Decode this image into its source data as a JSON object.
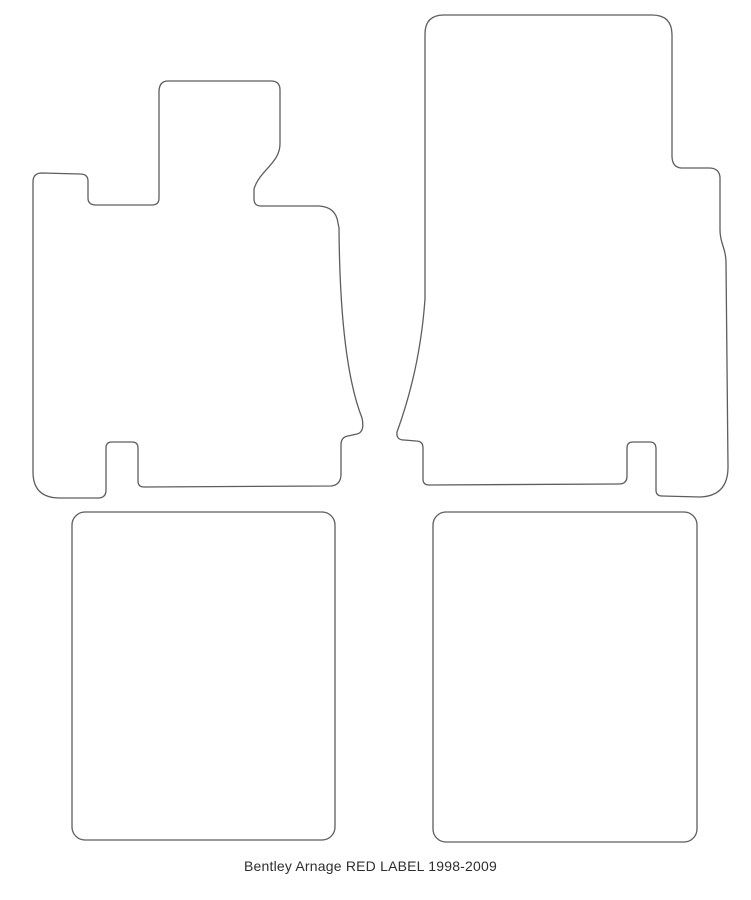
{
  "diagram": {
    "caption": "Bentley Arnage RED LABEL 1998-2009",
    "colors": {
      "background": "#ffffff",
      "outline": "#5d5d5d",
      "caption_text": "#2e2e2e"
    },
    "mats": [
      {
        "label": "front-left-mat"
      },
      {
        "label": "front-right-mat"
      },
      {
        "label": "rear-left-mat"
      },
      {
        "label": "rear-right-mat"
      }
    ]
  }
}
